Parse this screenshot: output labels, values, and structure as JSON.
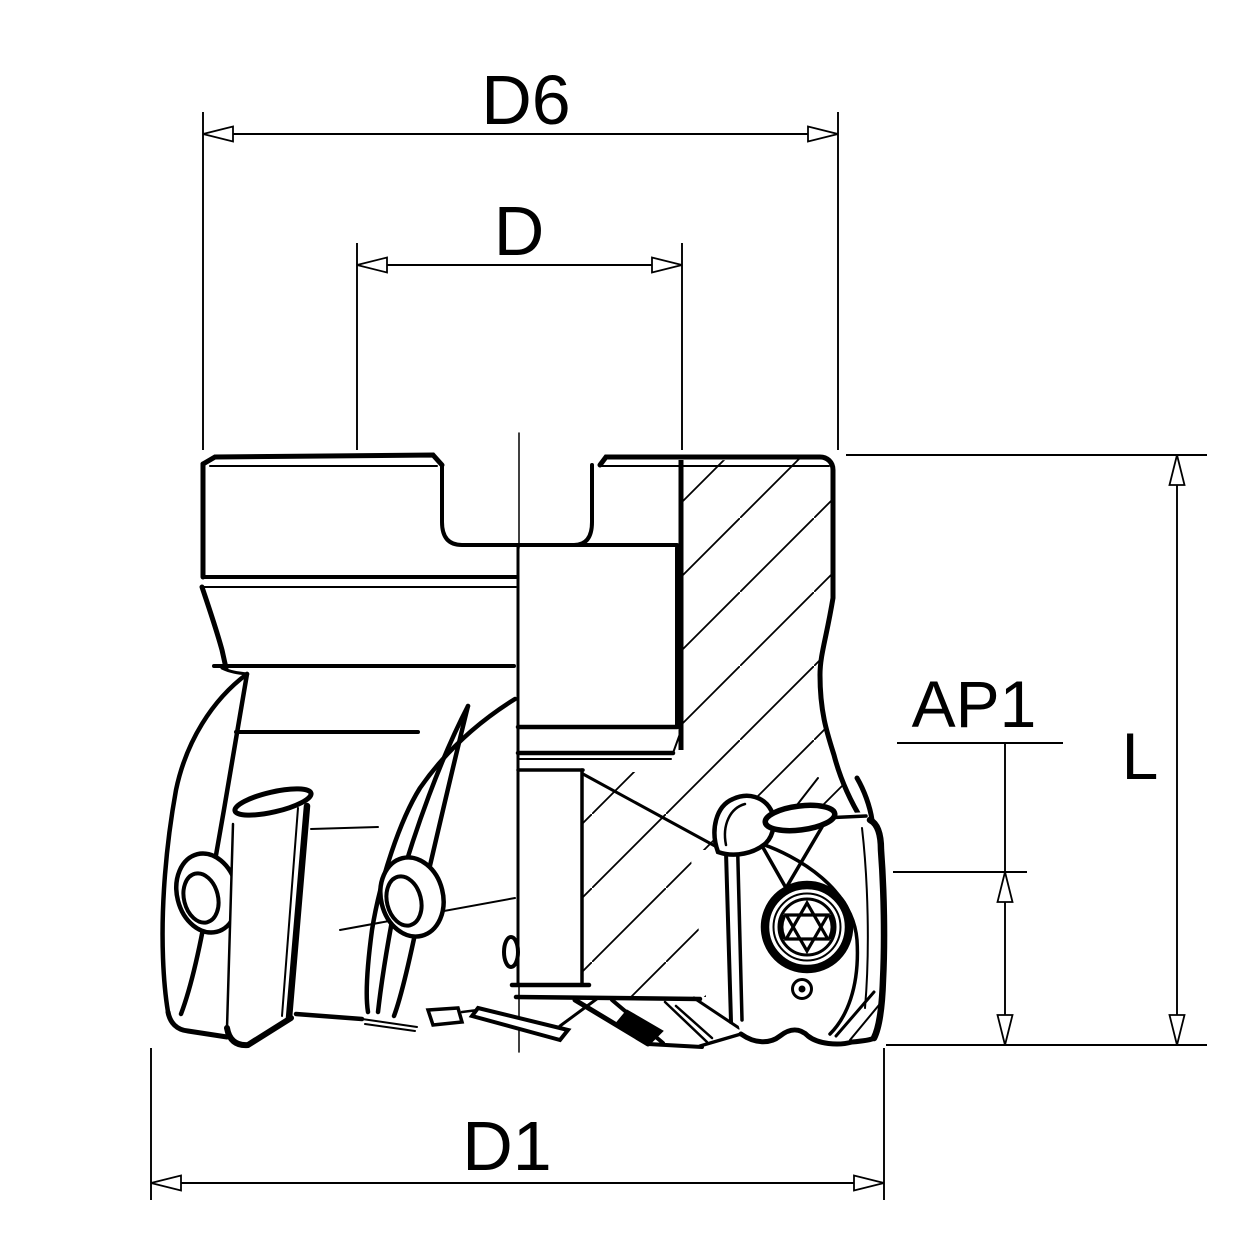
{
  "page": {
    "title": "Shoulder milling cutter - dimensioned section drawing",
    "background_color": "#ffffff",
    "line_color": "#000000"
  },
  "dimensions": {
    "d6": {
      "label": "D6"
    },
    "d": {
      "label": "D"
    },
    "ap1": {
      "label": "AP1"
    },
    "l": {
      "label": "L"
    },
    "d1": {
      "label": "D1"
    }
  }
}
